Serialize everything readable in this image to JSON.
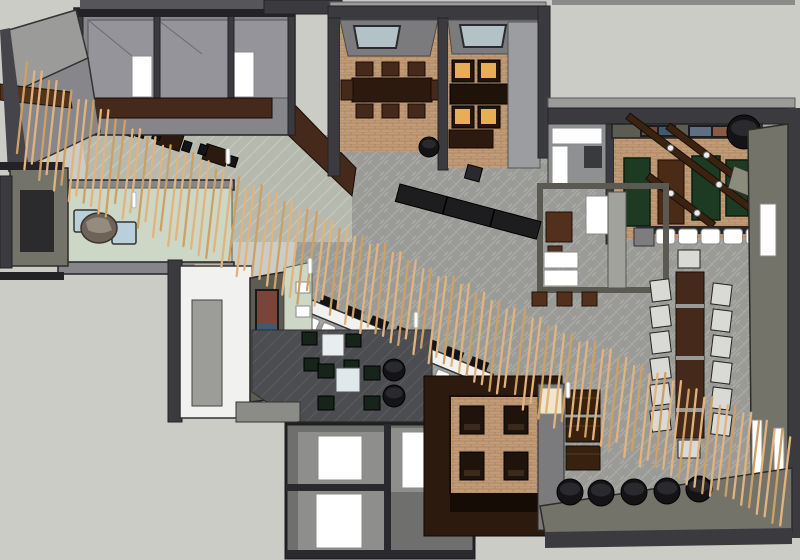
{
  "meta": {
    "type": "3d-floorplan-render",
    "description": "Top-down 3D cutaway rendering of a restaurant interior with a long diagonal wooden slat screen",
    "canvas": {
      "width": 800,
      "height": 560
    }
  },
  "palette": {
    "bg": "#cbccc6",
    "wallDark": "#3a3a3f",
    "wallDarker": "#232327",
    "wallMid": "#86868a",
    "wallLight": "#9b9b99",
    "roof": "#55555a",
    "roomFloor": "#94949a",
    "carpet": "#9a9b96",
    "carpetLine": "#a9aaa5",
    "carpetDark": "#4b4d51",
    "tile": "#b6b9ae",
    "tileLine": "#c6c9be",
    "brick": "#c29c77",
    "brickLine": "#a8825e",
    "walnut": "#45291a",
    "walnutDark": "#2c1a0f",
    "woodBeam": "#3b2312",
    "slat": "#e2b37d",
    "slatDark": "#cfa064",
    "boothGreen": "#1d3a23",
    "greenFloor": "#cdd7c6",
    "paleBlue": "#b9cfdb",
    "amber": "#e7ae55",
    "olive": "#73736a",
    "oliveDark": "#5c5c52",
    "cream": "#efe6cc",
    "skylight": "#b3c2c6",
    "white": "#ffffff",
    "offWhite": "#f1f1ef",
    "black": "#141416",
    "charcoal": "#2a2a2e",
    "stone": "#6f6359",
    "stoneLight": "#968b7f",
    "muralRust": "#7a4438",
    "muralBlue": "#3f5a6c",
    "muralBrown": "#7f4f38",
    "seatGray": "#d9d9d5",
    "darkSeat": "#16241a"
  },
  "inventory": [
    {
      "name": "wood-slat-screen",
      "qty": 100,
      "color": "slat",
      "note": "diagonal curtain of vertical slats from upper-left to lower-right"
    },
    {
      "name": "private-dining-room",
      "qty": 2,
      "floor": "brick",
      "note": "top-center rooms with skylights and walnut tables"
    },
    {
      "name": "amber-lit-chairs",
      "qty": 4,
      "color": "amber"
    },
    {
      "name": "green-booth",
      "qty": 3,
      "color": "boothGreen",
      "note": "top-right bar lounge"
    },
    {
      "name": "ceiling-beam-with-lights",
      "qty": 3,
      "color": "woodBeam"
    },
    {
      "name": "bar-stool-white",
      "qty": 16,
      "color": "white"
    },
    {
      "name": "communal-table",
      "qty": 1,
      "color": "walnut",
      "seats": 14
    },
    {
      "name": "diagonal-bar-counter",
      "qty": 1,
      "color": "offWhite"
    },
    {
      "name": "black-banquette",
      "qty": 1,
      "color": "black"
    },
    {
      "name": "black-cylinder-ottoman",
      "qty": 8,
      "color": "black"
    },
    {
      "name": "boulder-feature",
      "qty": 2,
      "color": "stone"
    },
    {
      "name": "mural-feature-wall",
      "qty": 1,
      "colors": [
        "muralRust",
        "muralBlue",
        "muralBrown"
      ]
    },
    {
      "name": "restroom",
      "qty": 3,
      "note": "bottom-center gray rooms with white fixtures"
    },
    {
      "name": "sunken-dining-pit",
      "qty": 1,
      "floor": "brick",
      "seats": 4
    },
    {
      "name": "lounge-cube-tables",
      "qty": 2,
      "color": "white"
    },
    {
      "name": "entry-vestibule",
      "qty": 1,
      "floor": "greenFloor",
      "note": "pale blue cube seats and boulder"
    }
  ],
  "generated": {
    "slat_segments": [
      {
        "x0": 22,
        "count": 13,
        "dx": 7.4,
        "y0": 66,
        "slope": 0.58,
        "length": 97
      },
      {
        "x0": 120,
        "count": 25,
        "dx": 7.6,
        "y0": 125,
        "slope": 0.47,
        "length": 88
      },
      {
        "x0": 312,
        "count": 27,
        "dx": 7.6,
        "y0": 216,
        "slope": 0.47,
        "length": 84
      },
      {
        "x0": 520,
        "count": 35,
        "dx": 7.8,
        "y0": 314,
        "slope": 0.45,
        "length": 90
      }
    ],
    "beams": [
      {
        "x": 628,
        "y": 116,
        "len": 152,
        "ang": 37
      },
      {
        "x": 668,
        "y": 126,
        "len": 138,
        "ang": 37
      },
      {
        "x": 648,
        "y": 176,
        "len": 82,
        "ang": 37
      }
    ],
    "stool_row": {
      "x0": 656,
      "y": 229,
      "dx": 22.5,
      "count": 5,
      "w": 19,
      "h": 15
    },
    "communal_chairs": {
      "leftX": 651,
      "rightX": 712,
      "y0": 280,
      "dy": 26,
      "count": 6,
      "w": 19,
      "h": 21
    },
    "cylinders_bottom": [
      [
        570,
        492,
        13
      ],
      [
        601,
        493,
        13
      ],
      [
        634,
        492,
        13
      ],
      [
        667,
        491,
        13
      ],
      [
        699,
        489,
        13
      ]
    ],
    "cylinders_lounge": [
      [
        394,
        370,
        11
      ],
      [
        394,
        396,
        11
      ]
    ],
    "pendant_lights": [
      [
        132,
        192
      ],
      [
        226,
        148
      ],
      [
        308,
        258
      ],
      [
        414,
        312
      ],
      [
        566,
        382
      ]
    ]
  }
}
